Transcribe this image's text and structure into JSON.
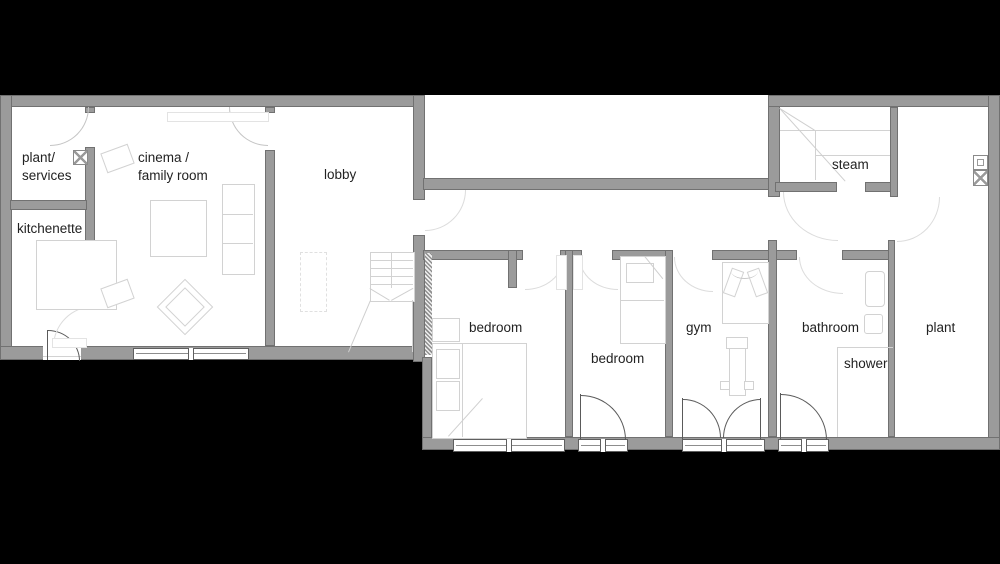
{
  "colors": {
    "background": "#000000",
    "floor": "#ffffff",
    "wall": "#9b9b9b",
    "wall_edge": "#717171",
    "door_line": "#5a5a5a",
    "furniture_line": "#d2d2d2",
    "text": "#222222"
  },
  "rooms": [
    {
      "id": "plant-services",
      "label": "plant/\nservices"
    },
    {
      "id": "cinema-family-room",
      "label": "cinema /\nfamily room"
    },
    {
      "id": "kitchenette",
      "label": "kitchenette"
    },
    {
      "id": "lobby",
      "label": "lobby"
    },
    {
      "id": "steam",
      "label": "steam"
    },
    {
      "id": "bedroom-1",
      "label": "bedroom"
    },
    {
      "id": "bedroom-2",
      "label": "bedroom"
    },
    {
      "id": "gym",
      "label": "gym"
    },
    {
      "id": "bathroom",
      "label": "bathroom"
    },
    {
      "id": "shower",
      "label": "shower"
    },
    {
      "id": "plant",
      "label": "plant"
    }
  ]
}
